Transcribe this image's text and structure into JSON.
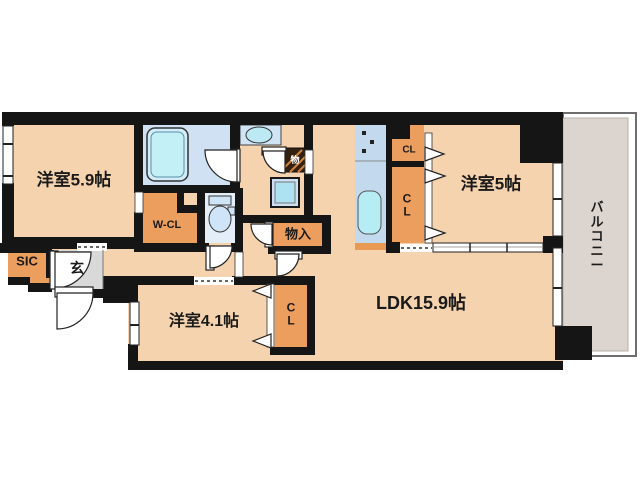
{
  "plan": {
    "rooms": {
      "bedroom_59": {
        "label": "洋室5.9帖"
      },
      "bedroom_5": {
        "label": "洋室5帖"
      },
      "bedroom_41": {
        "label": "洋室4.1帖"
      },
      "ldk": {
        "label": "LDK15.9帖"
      },
      "balcony": {
        "label": "バ\nル\nコ\nニ\nー"
      },
      "entrance": {
        "label": "玄"
      },
      "shoes_closet": {
        "label": "SIC"
      },
      "walk_in_closet": {
        "label": "W-CL"
      },
      "closet_kitchen": {
        "label": "CL"
      },
      "closet_bedroom5": {
        "label": "C\nL"
      },
      "closet_bedroom41": {
        "label": "C\nL"
      },
      "hall_storage": {
        "label": "物入"
      },
      "utility_storage": {
        "label": "物"
      }
    },
    "colors": {
      "wall": "#151515",
      "room_floor": "#f5d3ae",
      "closet": "#ec9e5e",
      "wet_area": "#cfe1f2",
      "fixture": "#bfeef5",
      "entrance_floor": "#d9d9d9",
      "balcony_floor": "#dcd5cf",
      "background": "#ffffff"
    }
  }
}
